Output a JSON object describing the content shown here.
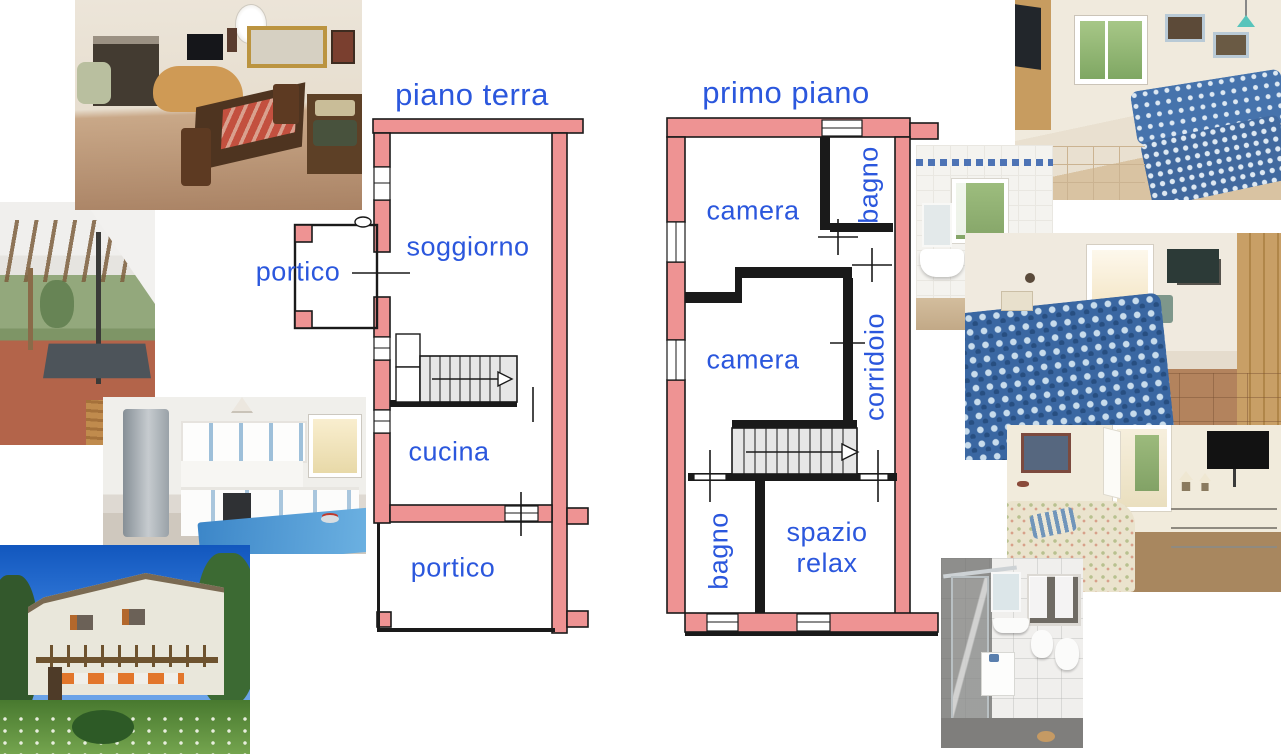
{
  "canvas": {
    "width": 1281,
    "height": 754,
    "background": "#ffffff"
  },
  "colors": {
    "plan_wall_pink": "#ee9393",
    "plan_line_black": "#1a1a1a",
    "label_blue": "#2b57dd",
    "stair_fill": "#e6e6e6"
  },
  "floor_plans": [
    {
      "id": "piano-terra",
      "title": "piano terra",
      "has_stairs": true,
      "rooms": [
        {
          "id": "portico-ovest",
          "label": "portico",
          "orientation": "horizontal"
        },
        {
          "id": "soggiorno",
          "label": "soggiorno",
          "orientation": "horizontal"
        },
        {
          "id": "cucina",
          "label": "cucina",
          "orientation": "horizontal"
        },
        {
          "id": "portico-sud",
          "label": "portico",
          "orientation": "horizontal"
        }
      ]
    },
    {
      "id": "primo-piano",
      "title": "primo piano",
      "has_stairs": true,
      "rooms": [
        {
          "id": "camera-nord",
          "label": "camera",
          "orientation": "horizontal"
        },
        {
          "id": "bagno-nord",
          "label": "bagno",
          "orientation": "vertical"
        },
        {
          "id": "camera-centro",
          "label": "camera",
          "orientation": "horizontal"
        },
        {
          "id": "corridoio",
          "label": "corridoio",
          "orientation": "vertical"
        },
        {
          "id": "bagno-sud",
          "label": "bagno",
          "orientation": "vertical"
        },
        {
          "id": "spazio-relax",
          "label_line1": "spazio",
          "label_line2": "relax",
          "orientation": "horizontal"
        }
      ]
    }
  ],
  "photos": [
    {
      "id": "living-room",
      "alt": "Living room with fireplace, wicker sofa, mirror and wooden dining table"
    },
    {
      "id": "portico",
      "alt": "Covered portico with wooden pergola, garden view and terracotta floor"
    },
    {
      "id": "kitchen",
      "alt": "Kitchen with steel fridge, white cabinets with blue trim and blue table"
    },
    {
      "id": "exterior",
      "alt": "Two-storey white house with pergola, orange shutters and green garden"
    },
    {
      "id": "twin-bedroom",
      "alt": "Bedroom with two single beds with blue patterned covers and TV"
    },
    {
      "id": "bathroom-upper",
      "alt": "White tiled bathroom with window, washbasin, toilet and bidet"
    },
    {
      "id": "double-bedroom",
      "alt": "Bedroom with blue patterned double bed, wall TV and wooden wardrobe"
    },
    {
      "id": "relax-room",
      "alt": "Relax space with floral sofa, chest of drawers, lamps and TV"
    },
    {
      "id": "bathroom-lower",
      "alt": "Grey tiled bathroom with glass shower, mirror, window and white fixtures"
    }
  ]
}
